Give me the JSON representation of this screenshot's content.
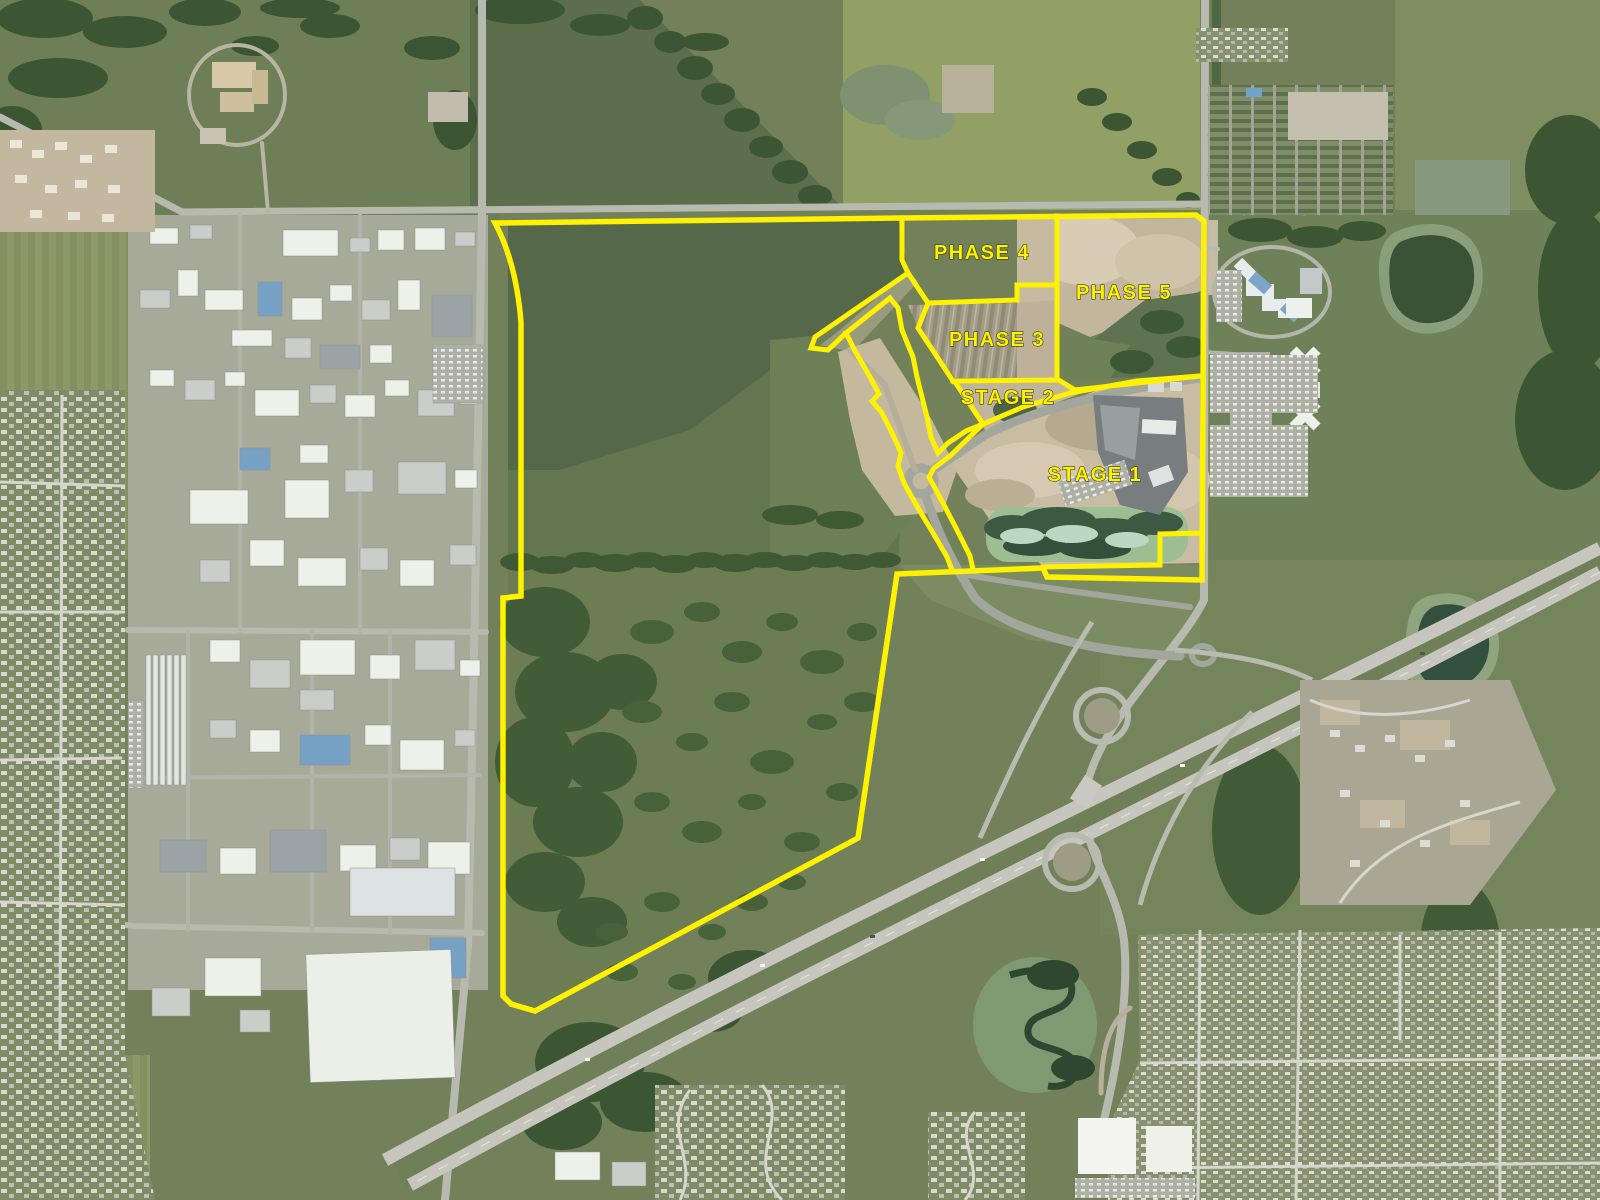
{
  "map": {
    "kind": "satellite-development-phasing-plan",
    "overlay": {
      "line_color": "#fef201",
      "label_color": "#fef201",
      "label_outline": "#3f3f1a",
      "labels": [
        {
          "id": "phase-4",
          "text": "PHASE 4"
        },
        {
          "id": "phase-5",
          "text": "PHASE 5"
        },
        {
          "id": "phase-3",
          "text": "PHASE 3"
        },
        {
          "id": "stage-2",
          "text": "STAGE 2"
        },
        {
          "id": "stage-1",
          "text": "STAGE 1"
        }
      ]
    }
  }
}
